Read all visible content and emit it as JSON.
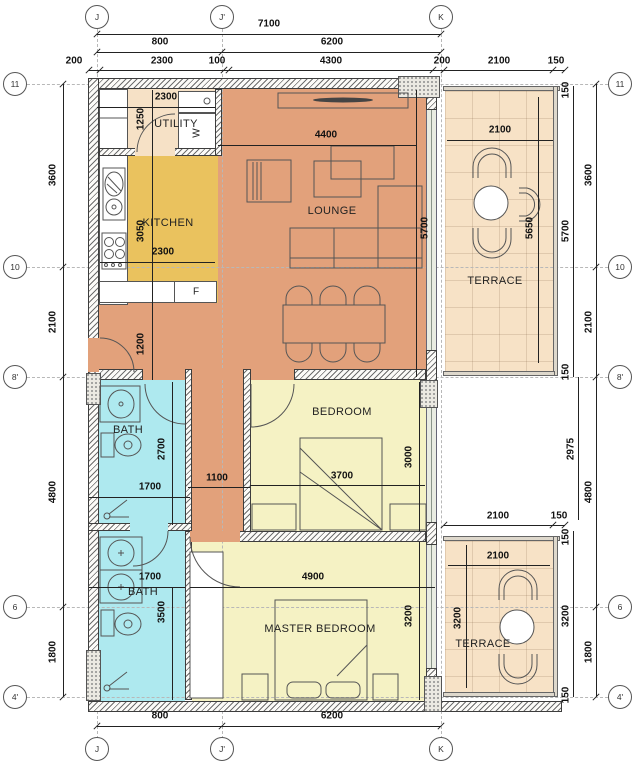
{
  "grid": {
    "top": [
      "J",
      "J'",
      "K"
    ],
    "bottom": [
      "J",
      "J'",
      "K"
    ],
    "left": [
      "11",
      "10",
      "8'",
      "6",
      "4'"
    ],
    "right": [
      "11",
      "10",
      "8'",
      "6",
      "4'"
    ]
  },
  "rooms": {
    "utility": "UTILITY",
    "kitchen": "KITCHEN",
    "lounge": "LOUNGE",
    "terrace_top": "TERRACE",
    "bath_top": "BATH",
    "bedroom": "BEDROOM",
    "bath_bottom": "BATH",
    "master_bedroom": "MASTER BEDROOM",
    "terrace_bottom": "TERRACE"
  },
  "appliances": {
    "washer": "W",
    "fridge": "F"
  },
  "dims": {
    "t_total": "7100",
    "t_800": "800",
    "t_6200": "6200",
    "t_200a": "200",
    "t_2300": "2300",
    "t_100": "100",
    "t_4300": "4300",
    "t_200b": "200",
    "t_2100": "2100",
    "t_150": "150",
    "l_3600": "3600",
    "l_2100": "2100",
    "l_4800": "4800",
    "l_1800": "1800",
    "r_150a": "150",
    "r_5700": "5700",
    "r_150b": "150",
    "r_3600": "3600",
    "r_2100": "2100",
    "r_2975": "2975",
    "r_4800": "4800",
    "r_150c": "150",
    "r_3200": "3200",
    "r_150d": "150",
    "r_1800": "1800",
    "tr1_w": "2100",
    "tr1_h": "5650",
    "lounge_w": "4400",
    "lounge_h": "5700",
    "ut_w": "2300",
    "ut_h": "1250",
    "k_h": "3050",
    "k_w": "2300",
    "hall_h": "1200",
    "b1_h": "2700",
    "b1_w": "1700",
    "cor_w": "1100",
    "bed_w": "3700",
    "bed_h": "3000",
    "b2_w": "1700",
    "b2_h": "3500",
    "m_w": "4900",
    "m_h": "3200",
    "tr2_wo": "2100",
    "tr2_150": "150",
    "tr2_w": "2100",
    "tr2_h": "3200",
    "b_800": "800",
    "b_6200": "6200"
  },
  "colors": {
    "lounge": "#e2a17b",
    "kitchen": "#eac25e",
    "utility": "#f6e1c6",
    "terrace": "#f7e2c6",
    "bath": "#aee9ef",
    "bedroom": "#f5f2c4",
    "glazing": "#e9ece2"
  }
}
